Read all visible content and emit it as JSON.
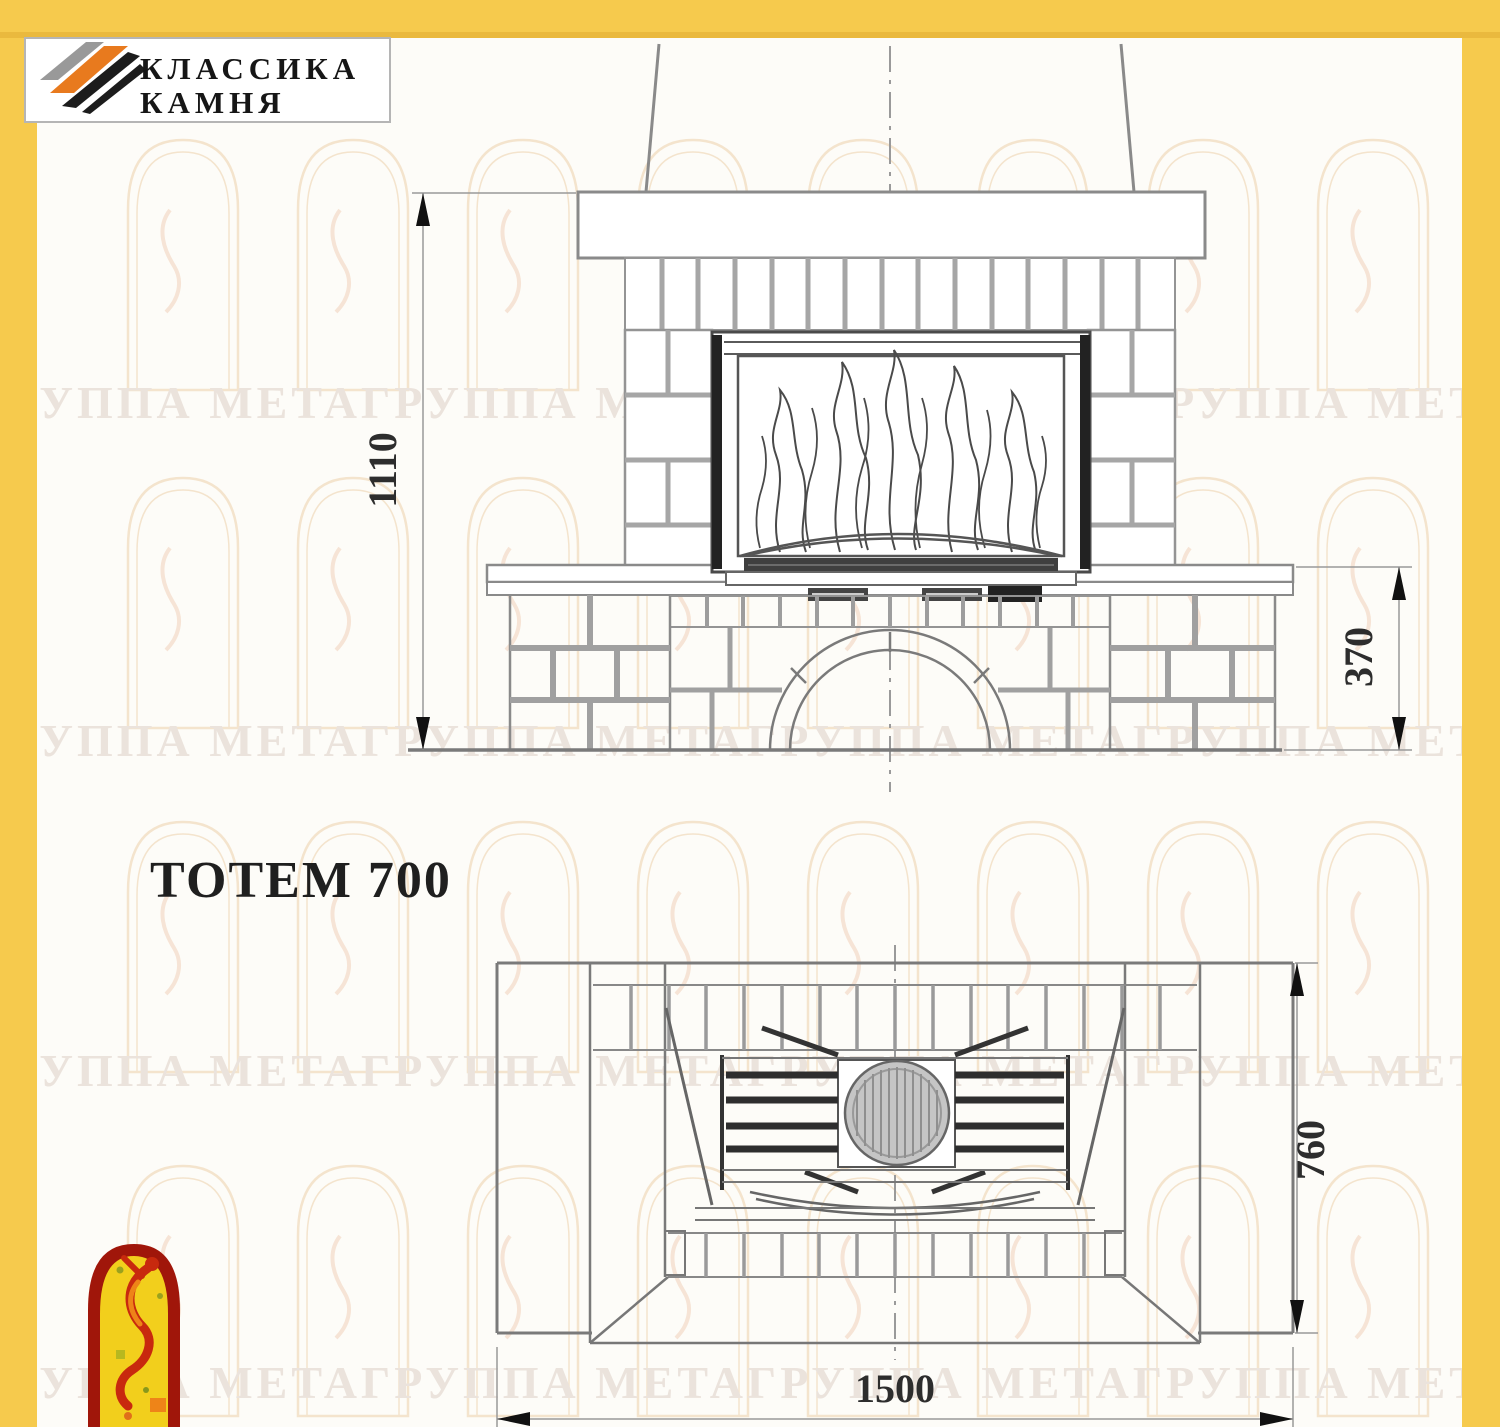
{
  "page": {
    "paper_color": "#fdfcf8",
    "frame_color": "#f6c94c"
  },
  "logo": {
    "line1": "КЛАССИКА",
    "line2": "КАМНЯ",
    "stripe_colors": [
      "#999999",
      "#e87a1e",
      "#1c1c1c"
    ]
  },
  "title": {
    "text": "ТОТЕМ 700"
  },
  "views": {
    "front": {
      "label": "front-elevation-of-fireplace",
      "dimensions": {
        "height": "1110",
        "plinth_height": "370"
      }
    },
    "plan": {
      "label": "top-plan-of-fireplace",
      "dimensions": {
        "depth": "760",
        "width": "1500"
      }
    }
  },
  "watermark": {
    "text": "ГРУППА МЕТАГРУППА МЕТАГРУППА МЕТАГРУППА МЕТАГРУППА",
    "emblem": "fire-dancer-arch-emblem"
  }
}
